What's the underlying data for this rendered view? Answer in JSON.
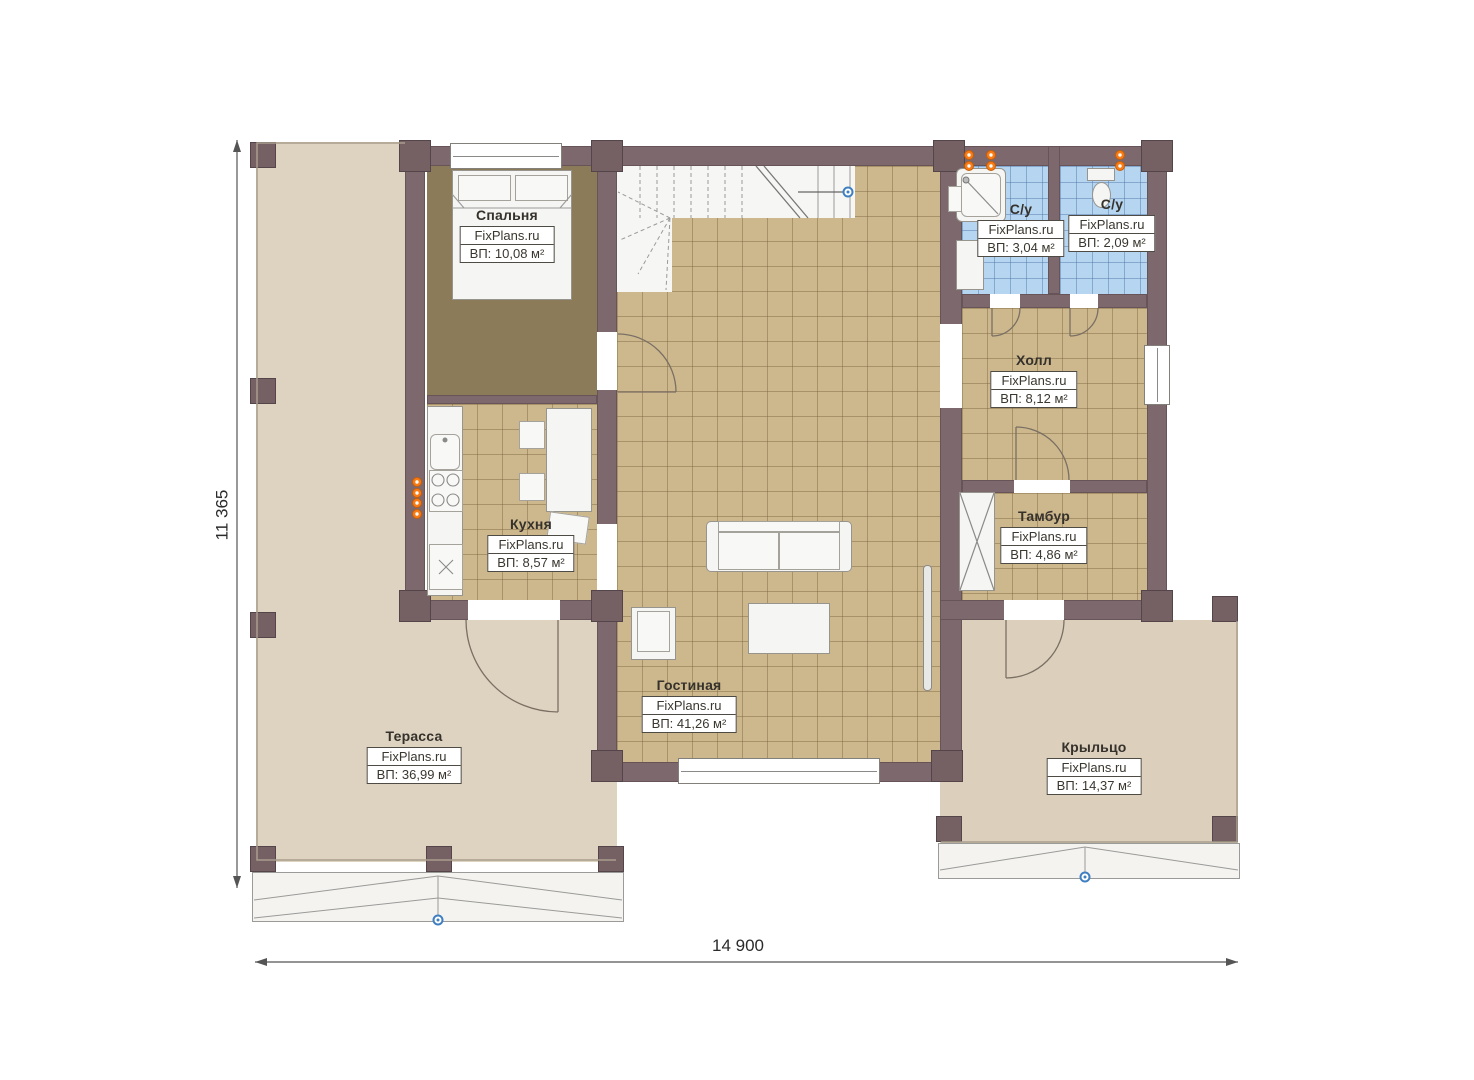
{
  "plan": {
    "type": "floor-plan",
    "watermark": "FixPlans.ru"
  },
  "dimensions": {
    "height_label": "11 365",
    "width_label": "14 900"
  },
  "rooms": [
    {
      "id": "bedroom",
      "name": "Спальня",
      "brand": "FixPlans.ru",
      "area": "ВП: 10,08 м²"
    },
    {
      "id": "bathroom-shower",
      "name": "С/у",
      "brand": "FixPlans.ru",
      "area": "ВП: 3,04 м²"
    },
    {
      "id": "bathroom-wc",
      "name": "С/у",
      "brand": "FixPlans.ru",
      "area": "ВП: 2,09 м²"
    },
    {
      "id": "hall",
      "name": "Холл",
      "brand": "FixPlans.ru",
      "area": "ВП: 8,12 м²"
    },
    {
      "id": "kitchen",
      "name": "Кухня",
      "brand": "FixPlans.ru",
      "area": "ВП: 8,57 м²"
    },
    {
      "id": "vestibule",
      "name": "Тамбур",
      "brand": "FixPlans.ru",
      "area": "ВП: 4,86 м²"
    },
    {
      "id": "living-room",
      "name": "Гостиная",
      "brand": "FixPlans.ru",
      "area": "ВП: 41,26 м²"
    },
    {
      "id": "terrace",
      "name": "Терасса",
      "brand": "FixPlans.ru",
      "area": "ВП: 36,99 м²"
    },
    {
      "id": "porch",
      "name": "Крыльцо",
      "brand": "FixPlans.ru",
      "area": "ВП: 14,37 м²"
    }
  ],
  "colors": {
    "wall": "#7d696d",
    "tile_floor": "#cdb88e",
    "bathroom_tile": "#b6d5f1",
    "bedroom_floor": "#8b7b59",
    "terrace_floor": "#ded3c1",
    "porch_floor": "#dcd0bd",
    "plumbing_point": "#f97b16",
    "marker": "#3f7fc1"
  }
}
